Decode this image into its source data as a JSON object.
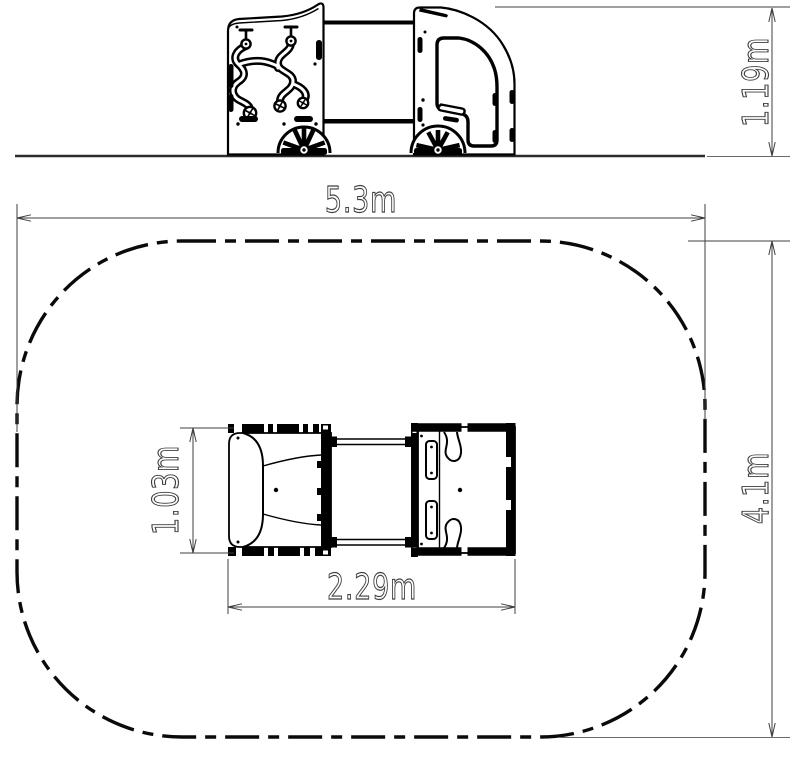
{
  "drawing": {
    "dimensions": {
      "equipment_height": "1.19m",
      "safety_zone_length": "5.3m",
      "safety_zone_width": "4.1m",
      "equipment_length": "2.29m",
      "equipment_width": "1.03m"
    },
    "colors": {
      "background": "#ffffff",
      "line": "#000000",
      "dimension": "#3f3f3f",
      "ground": "#2b2b2b"
    }
  }
}
